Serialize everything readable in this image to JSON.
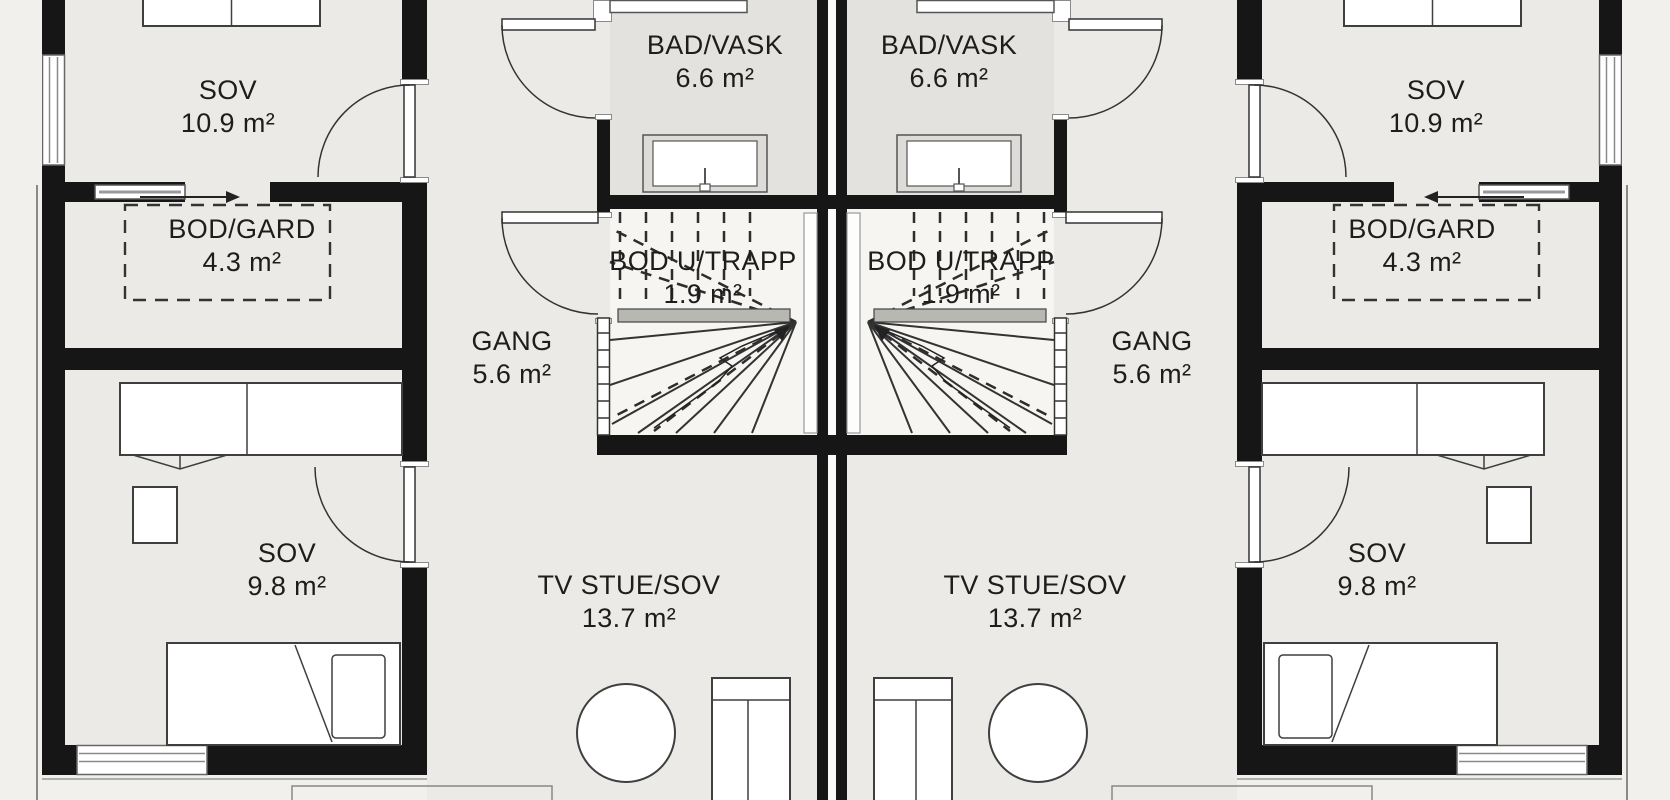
{
  "rooms": {
    "sov_top": {
      "name": "SOV",
      "area": "10.9 m²"
    },
    "bad_vask": {
      "name": "BAD/VASK",
      "area": "6.6 m²"
    },
    "bod_gard": {
      "name": "BOD/GARD",
      "area": "4.3 m²"
    },
    "bod_u_trapp": {
      "name": "BOD U/TRAPP",
      "area": "1.9 m²"
    },
    "gang": {
      "name": "GANG",
      "area": "5.6 m²"
    },
    "sov_bottom": {
      "name": "SOV",
      "area": "9.8 m²"
    },
    "tv_stue": {
      "name": "TV STUE/SOV",
      "area": "13.7 m²"
    }
  },
  "colors": {
    "wall": "#161616",
    "floor": "#ebeae6",
    "floor_bath": "#e3e2df",
    "floor_stair": "#f6f5f1",
    "background": "#f1f0ec",
    "line": "#3a3a3a"
  }
}
